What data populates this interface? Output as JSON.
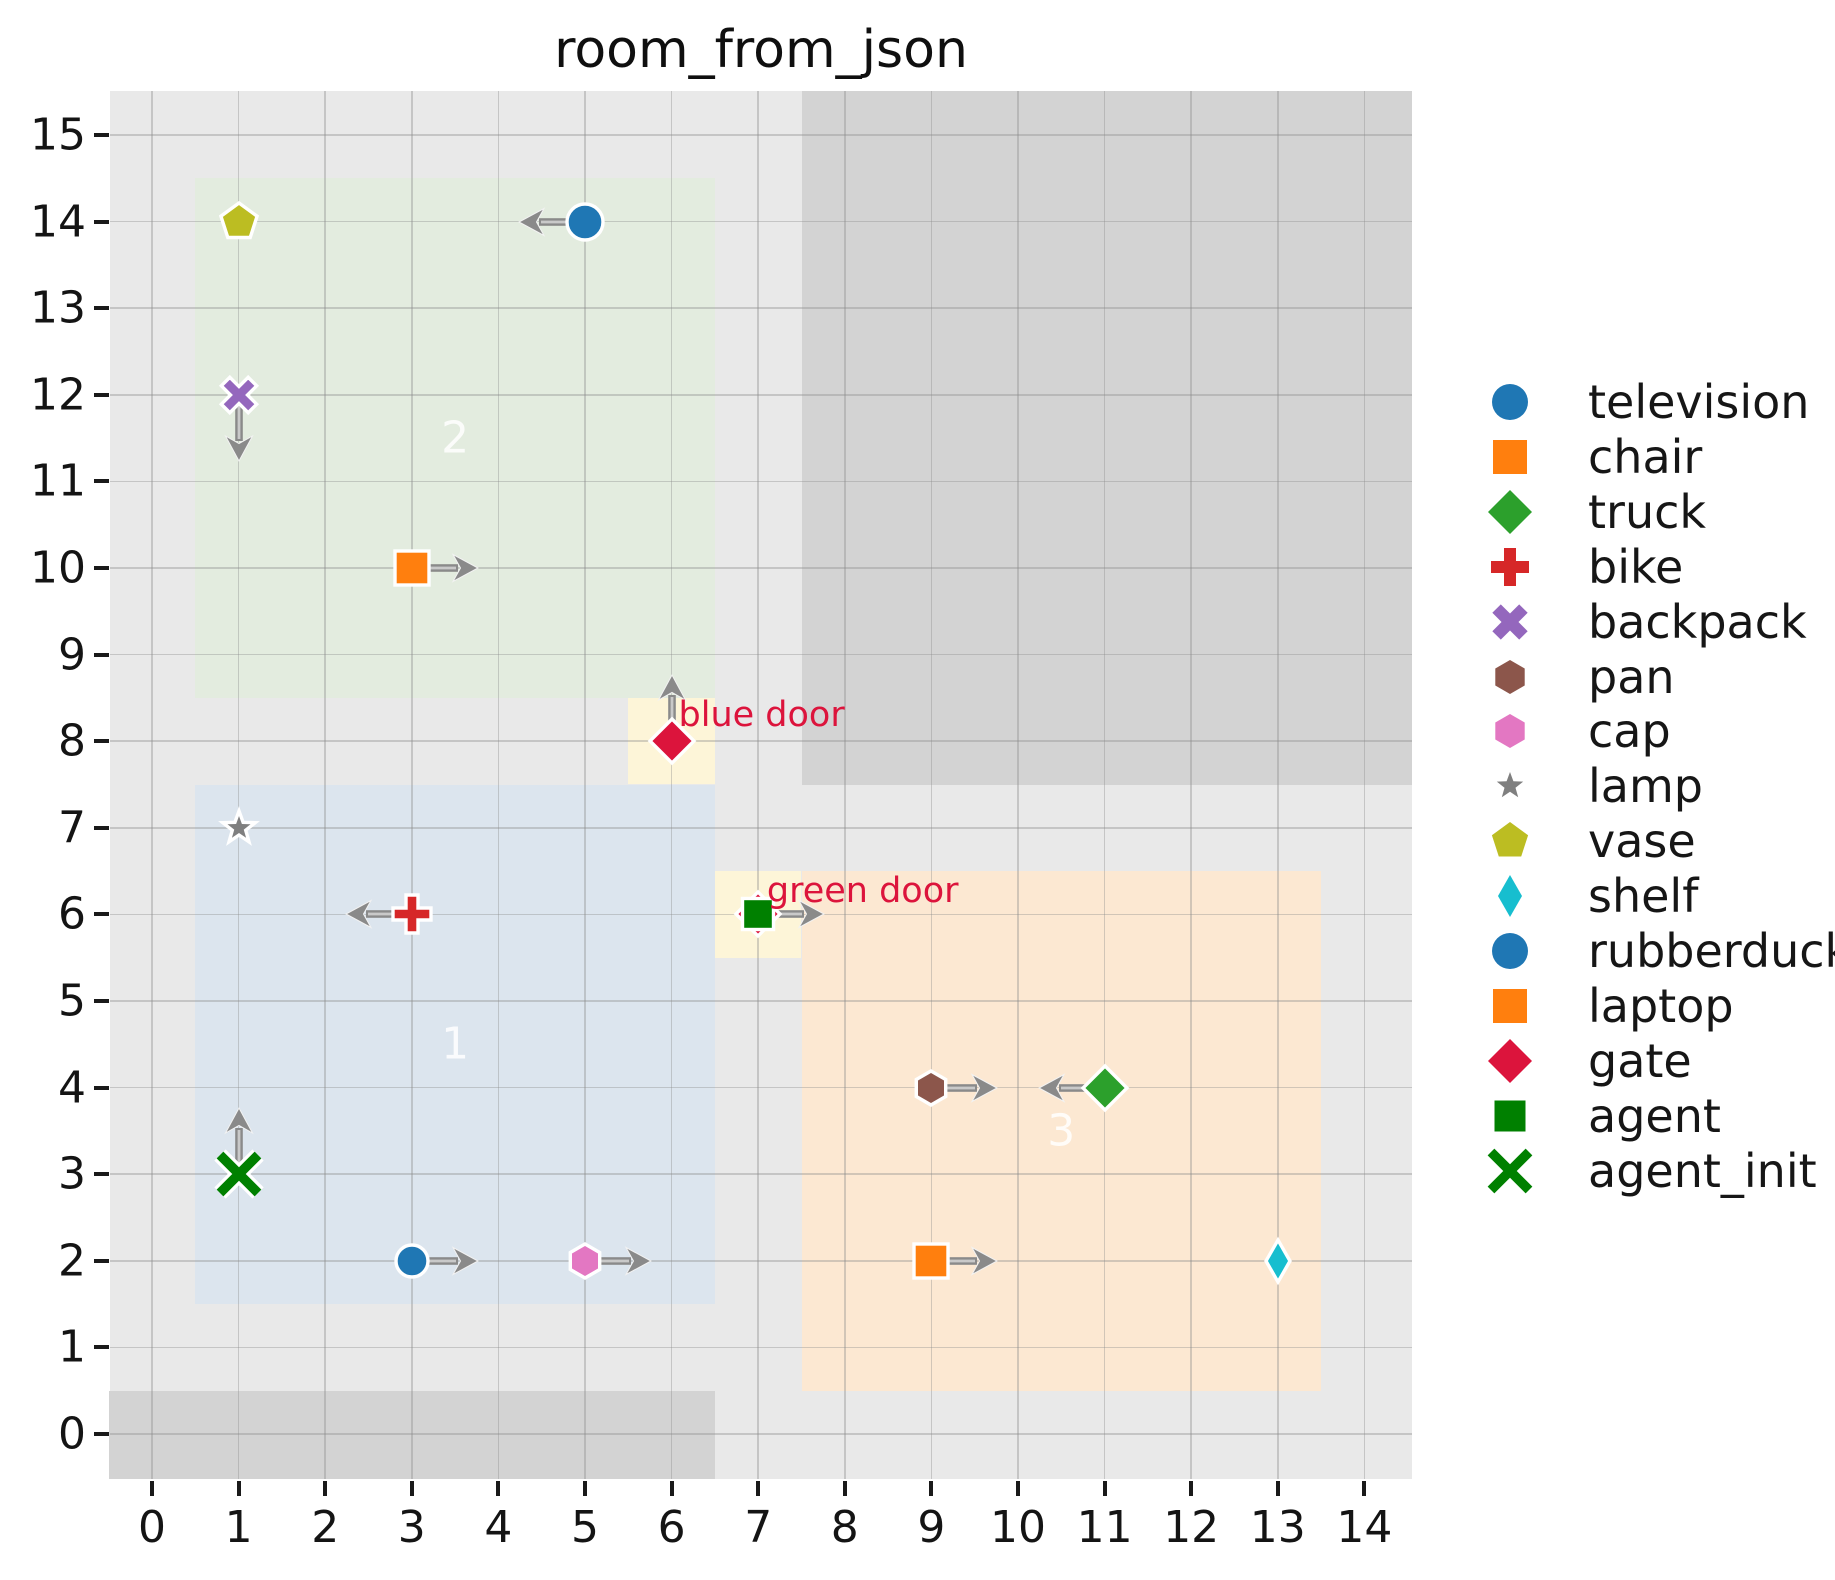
{
  "chart_data": {
    "type": "scatter",
    "title": "room_from_json",
    "xlabel": "",
    "ylabel": "",
    "xlim": [
      -0.5,
      14.55
    ],
    "ylim": [
      -0.52,
      15.51
    ],
    "grid": true,
    "x_ticks": [
      "0",
      "1",
      "2",
      "3",
      "4",
      "5",
      "6",
      "7",
      "8",
      "9",
      "10",
      "11",
      "12",
      "13",
      "14"
    ],
    "y_ticks": [
      "0",
      "1",
      "2",
      "3",
      "4",
      "5",
      "6",
      "7",
      "8",
      "9",
      "10",
      "11",
      "12",
      "13",
      "14",
      "15"
    ],
    "colors": {
      "plot_background": "#e9e9e9",
      "wall": "#d3d3d3",
      "door_fill": "#fdf5d8",
      "door_label": "#dc143c",
      "arrow": "#8a8a8a",
      "arrow_core": "#c9c9c9",
      "room_label": "rgba(255,255,255,0.85)",
      "tick_text": "#141414"
    },
    "walls": [
      {
        "name": "wall-top-right",
        "x0": 7.5,
        "y0": 7.5,
        "x1": 14.55,
        "y1": 15.51
      },
      {
        "name": "wall-bottom-left",
        "x0": -0.5,
        "y0": -0.52,
        "x1": 6.5,
        "y1": 0.5
      }
    ],
    "rooms": [
      {
        "id": "2",
        "color": "#e3ecdf",
        "x0": 0.5,
        "y0": 8.5,
        "x1": 6.5,
        "y1": 14.5,
        "label_x": 3.5,
        "label_y": 11.5
      },
      {
        "id": "1",
        "color": "#dce5ee",
        "x0": 0.5,
        "y0": 1.5,
        "x1": 6.5,
        "y1": 7.5,
        "label_x": 3.5,
        "label_y": 4.5
      },
      {
        "id": "3",
        "color": "#fce8d2",
        "x0": 7.5,
        "y0": 0.5,
        "x1": 13.5,
        "y1": 6.5,
        "label_x": 10.5,
        "label_y": 3.5
      }
    ],
    "doors": [
      {
        "label": "blue door",
        "x0": 5.5,
        "y0": 7.5,
        "x1": 6.5,
        "y1": 8.5,
        "text_x": 6.08,
        "text_y": 8.3
      },
      {
        "label": "green door",
        "x0": 6.5,
        "y0": 5.5,
        "x1": 7.5,
        "y1": 6.5,
        "text_x": 7.1,
        "text_y": 6.27
      }
    ],
    "objects": [
      {
        "name": "television",
        "marker": "circle",
        "color": "#1f77b4",
        "x": 5,
        "y": 14,
        "arrow": "left"
      },
      {
        "name": "vase",
        "marker": "pentagon",
        "color": "#bcbd22",
        "x": 1,
        "y": 14,
        "arrow": null
      },
      {
        "name": "backpack",
        "marker": "x-thick",
        "color": "#9467bd",
        "x": 1,
        "y": 12,
        "arrow": "down"
      },
      {
        "name": "chair",
        "marker": "square",
        "color": "#ff7f0e",
        "x": 3,
        "y": 10,
        "arrow": "right"
      },
      {
        "name": "gate",
        "marker": "diamond",
        "color": "#dc143c",
        "x": 6,
        "y": 8,
        "arrow": "up"
      },
      {
        "name": "lamp",
        "marker": "star",
        "color": "#7f7f7f",
        "x": 1,
        "y": 7,
        "arrow": null
      },
      {
        "name": "bike",
        "marker": "plus",
        "color": "#d62728",
        "x": 3,
        "y": 6,
        "arrow": "left"
      },
      {
        "name": "gate",
        "marker": "diamond",
        "color": "#dc143c",
        "x": 7,
        "y": 6,
        "arrow": null
      },
      {
        "name": "agent",
        "marker": "square-small",
        "color": "#008000",
        "x": 7,
        "y": 6,
        "arrow": "right"
      },
      {
        "name": "agent_init",
        "marker": "x-line",
        "color": "#008000",
        "x": 1,
        "y": 3,
        "arrow": "up"
      },
      {
        "name": "rubberduck",
        "marker": "circle-small",
        "color": "#1f77b4",
        "x": 3,
        "y": 2,
        "arrow": "right"
      },
      {
        "name": "cap",
        "marker": "hexagon",
        "color": "#e377c2",
        "x": 5,
        "y": 2,
        "arrow": "right"
      },
      {
        "name": "pan",
        "marker": "hexagon",
        "color": "#8c564b",
        "x": 9,
        "y": 4,
        "arrow": "right"
      },
      {
        "name": "truck",
        "marker": "diamond",
        "color": "#2ca02c",
        "x": 11,
        "y": 4,
        "arrow": "left"
      },
      {
        "name": "laptop",
        "marker": "square",
        "color": "#ff7f0e",
        "x": 9,
        "y": 2,
        "arrow": "right"
      },
      {
        "name": "shelf",
        "marker": "thin-diamond",
        "color": "#17becf",
        "x": 13,
        "y": 2,
        "arrow": null
      }
    ],
    "legend": {
      "position": "right",
      "entries": [
        {
          "label": "television",
          "marker": "circle",
          "color": "#1f77b4"
        },
        {
          "label": "chair",
          "marker": "square",
          "color": "#ff7f0e"
        },
        {
          "label": "truck",
          "marker": "diamond",
          "color": "#2ca02c"
        },
        {
          "label": "bike",
          "marker": "plus",
          "color": "#d62728"
        },
        {
          "label": "backpack",
          "marker": "x-thick",
          "color": "#9467bd"
        },
        {
          "label": "pan",
          "marker": "hexagon",
          "color": "#8c564b"
        },
        {
          "label": "cap",
          "marker": "hexagon",
          "color": "#e377c2"
        },
        {
          "label": "lamp",
          "marker": "star-small",
          "color": "#7f7f7f"
        },
        {
          "label": "vase",
          "marker": "pentagon",
          "color": "#bcbd22"
        },
        {
          "label": "shelf",
          "marker": "thin-diamond",
          "color": "#17becf"
        },
        {
          "label": "rubberduck",
          "marker": "circle",
          "color": "#1f77b4"
        },
        {
          "label": "laptop",
          "marker": "square",
          "color": "#ff7f0e"
        },
        {
          "label": "gate",
          "marker": "diamond",
          "color": "#dc143c"
        },
        {
          "label": "agent",
          "marker": "square-small",
          "color": "#008000"
        },
        {
          "label": "agent_init",
          "marker": "x-line",
          "color": "#008000"
        }
      ]
    }
  }
}
